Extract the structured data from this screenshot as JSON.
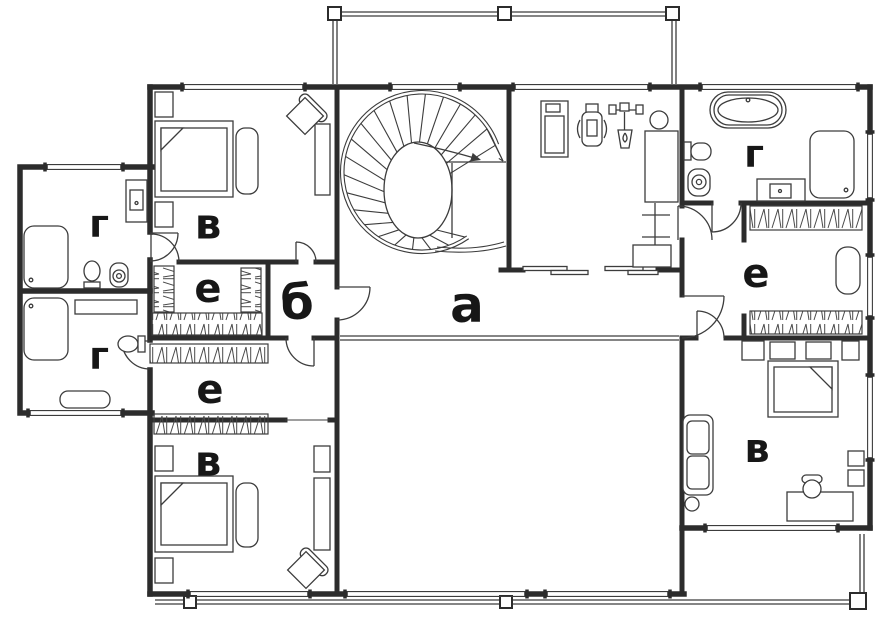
{
  "floorplan": {
    "labels": {
      "hall": "а",
      "vestibule": "б",
      "bedroom_top_left": "в",
      "bedroom_bottom_left": "в",
      "bedroom_right": "в",
      "bathroom_upper_left": "г",
      "bathroom_lower_left": "г",
      "bathroom_top_right": "г",
      "dressing_upper_left": "е",
      "dressing_lower_left": "е",
      "dressing_right": "е"
    },
    "colors": {
      "wall": "#2c2c2c",
      "line": "#3c3c3c",
      "label": "#171717",
      "background": "#ffffff"
    }
  }
}
